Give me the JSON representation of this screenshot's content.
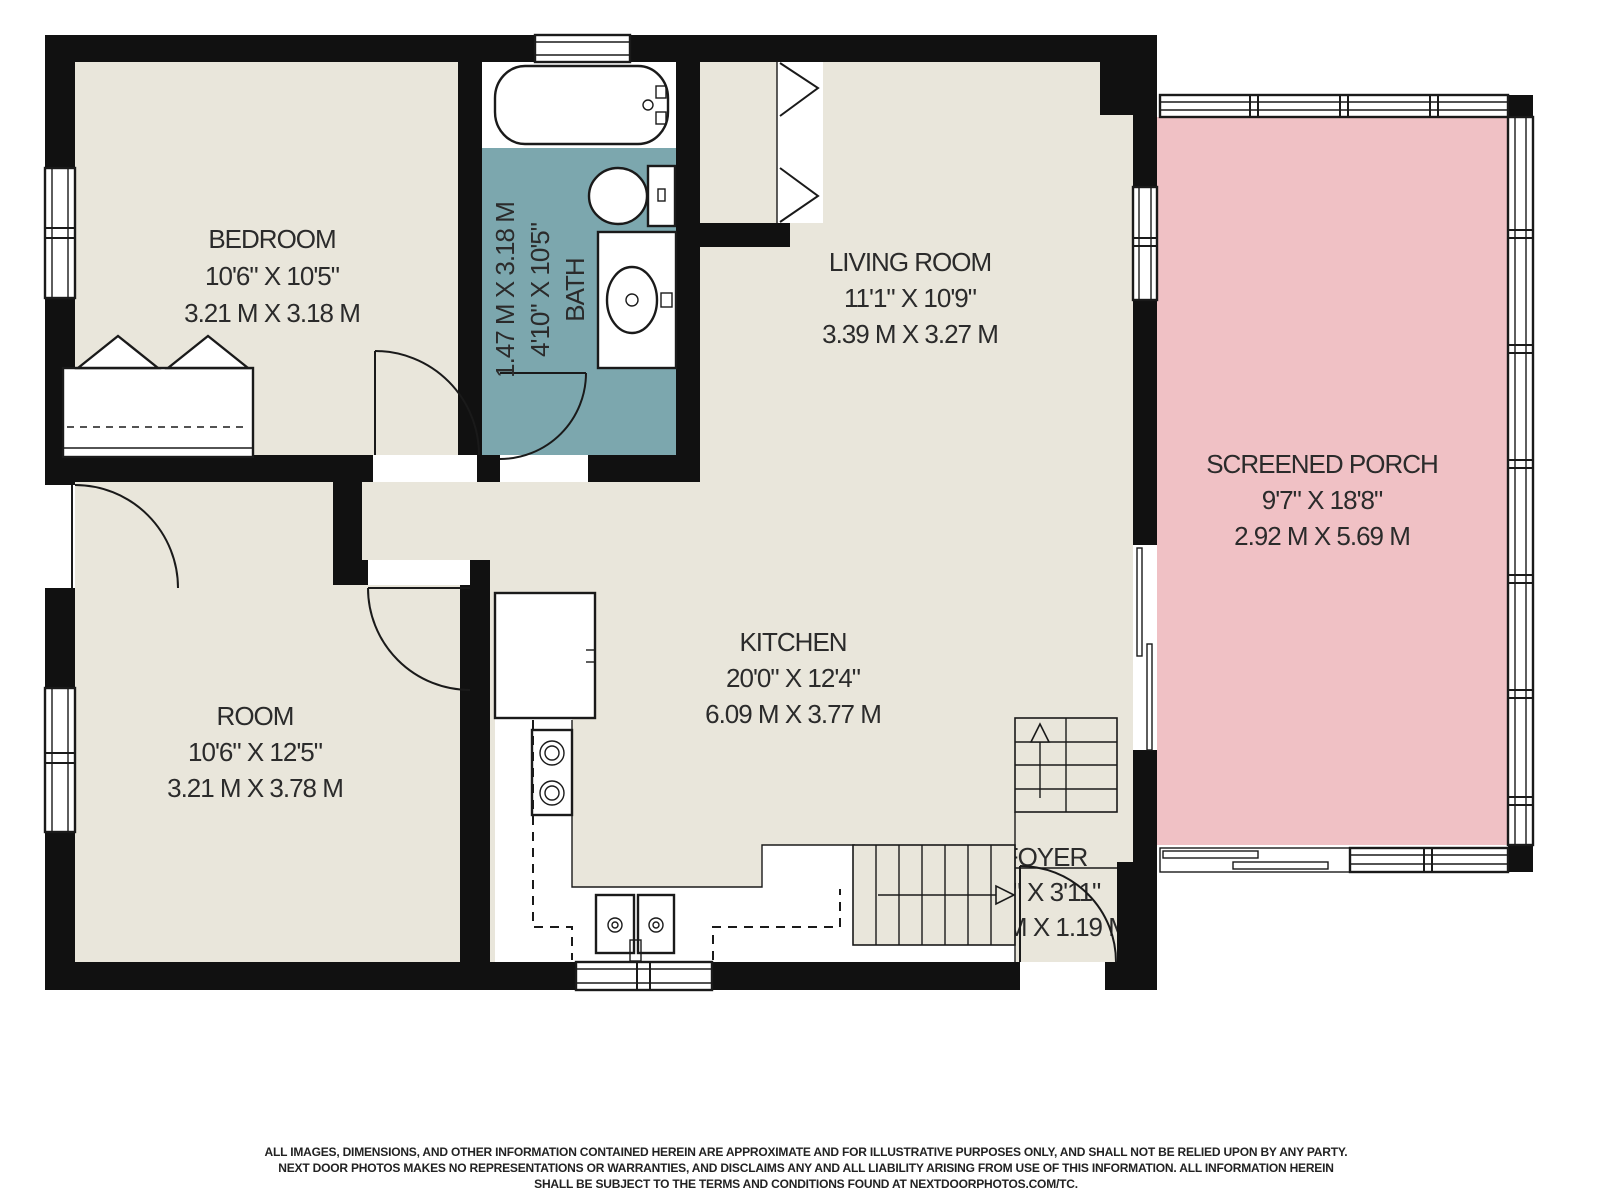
{
  "rooms": {
    "bedroom": {
      "name": "BEDROOM",
      "imperial": "10'6\" X 10'5\"",
      "metric": "3.21 M X 3.18 M"
    },
    "bath": {
      "name": "BATH",
      "imperial": "4'10\" X 10'5\"",
      "metric": "1.47 M X 3.18 M"
    },
    "living_room": {
      "name": "LIVING ROOM",
      "imperial": "11'1\" X 10'9\"",
      "metric": "3.39 M X 3.27 M"
    },
    "screened_porch": {
      "name": "SCREENED PORCH",
      "imperial": "9'7\" X 18'8\"",
      "metric": "2.92 M X 5.69 M"
    },
    "room": {
      "name": "ROOM",
      "imperial": "10'6\" X 12'5\"",
      "metric": "3.21 M X 3.78 M"
    },
    "kitchen": {
      "name": "KITCHEN",
      "imperial": "20'0\" X 12'4\"",
      "metric": "6.09 M X 3.77 M"
    },
    "foyer": {
      "name": "FOYER",
      "imperial": "2'7\" X 3'11\"",
      "metric": "0.79 M X 1.19 M"
    }
  },
  "disclaimer": {
    "line1": "ALL IMAGES, DIMENSIONS, AND OTHER INFORMATION CONTAINED HEREIN ARE APPROXIMATE AND FOR ILLUSTRATIVE PURPOSES ONLY, AND SHALL NOT BE RELIED UPON BY ANY PARTY.",
    "line2": "NEXT DOOR PHOTOS MAKES NO REPRESENTATIONS OR WARRANTIES, AND DISCLAIMS ANY AND ALL LIABILITY ARISING FROM USE OF THIS INFORMATION. ALL INFORMATION HEREIN",
    "line3": "SHALL BE SUBJECT TO THE TERMS AND CONDITIONS FOUND AT NEXTDOORPHOTOS.COM/TC."
  },
  "colors": {
    "floor": "#E9E6DB",
    "bath_floor": "#7CA7AE",
    "porch_floor": "#F0C1C5",
    "wall": "#111111",
    "line": "#1a1a1a",
    "text": "#2b2b2b"
  }
}
